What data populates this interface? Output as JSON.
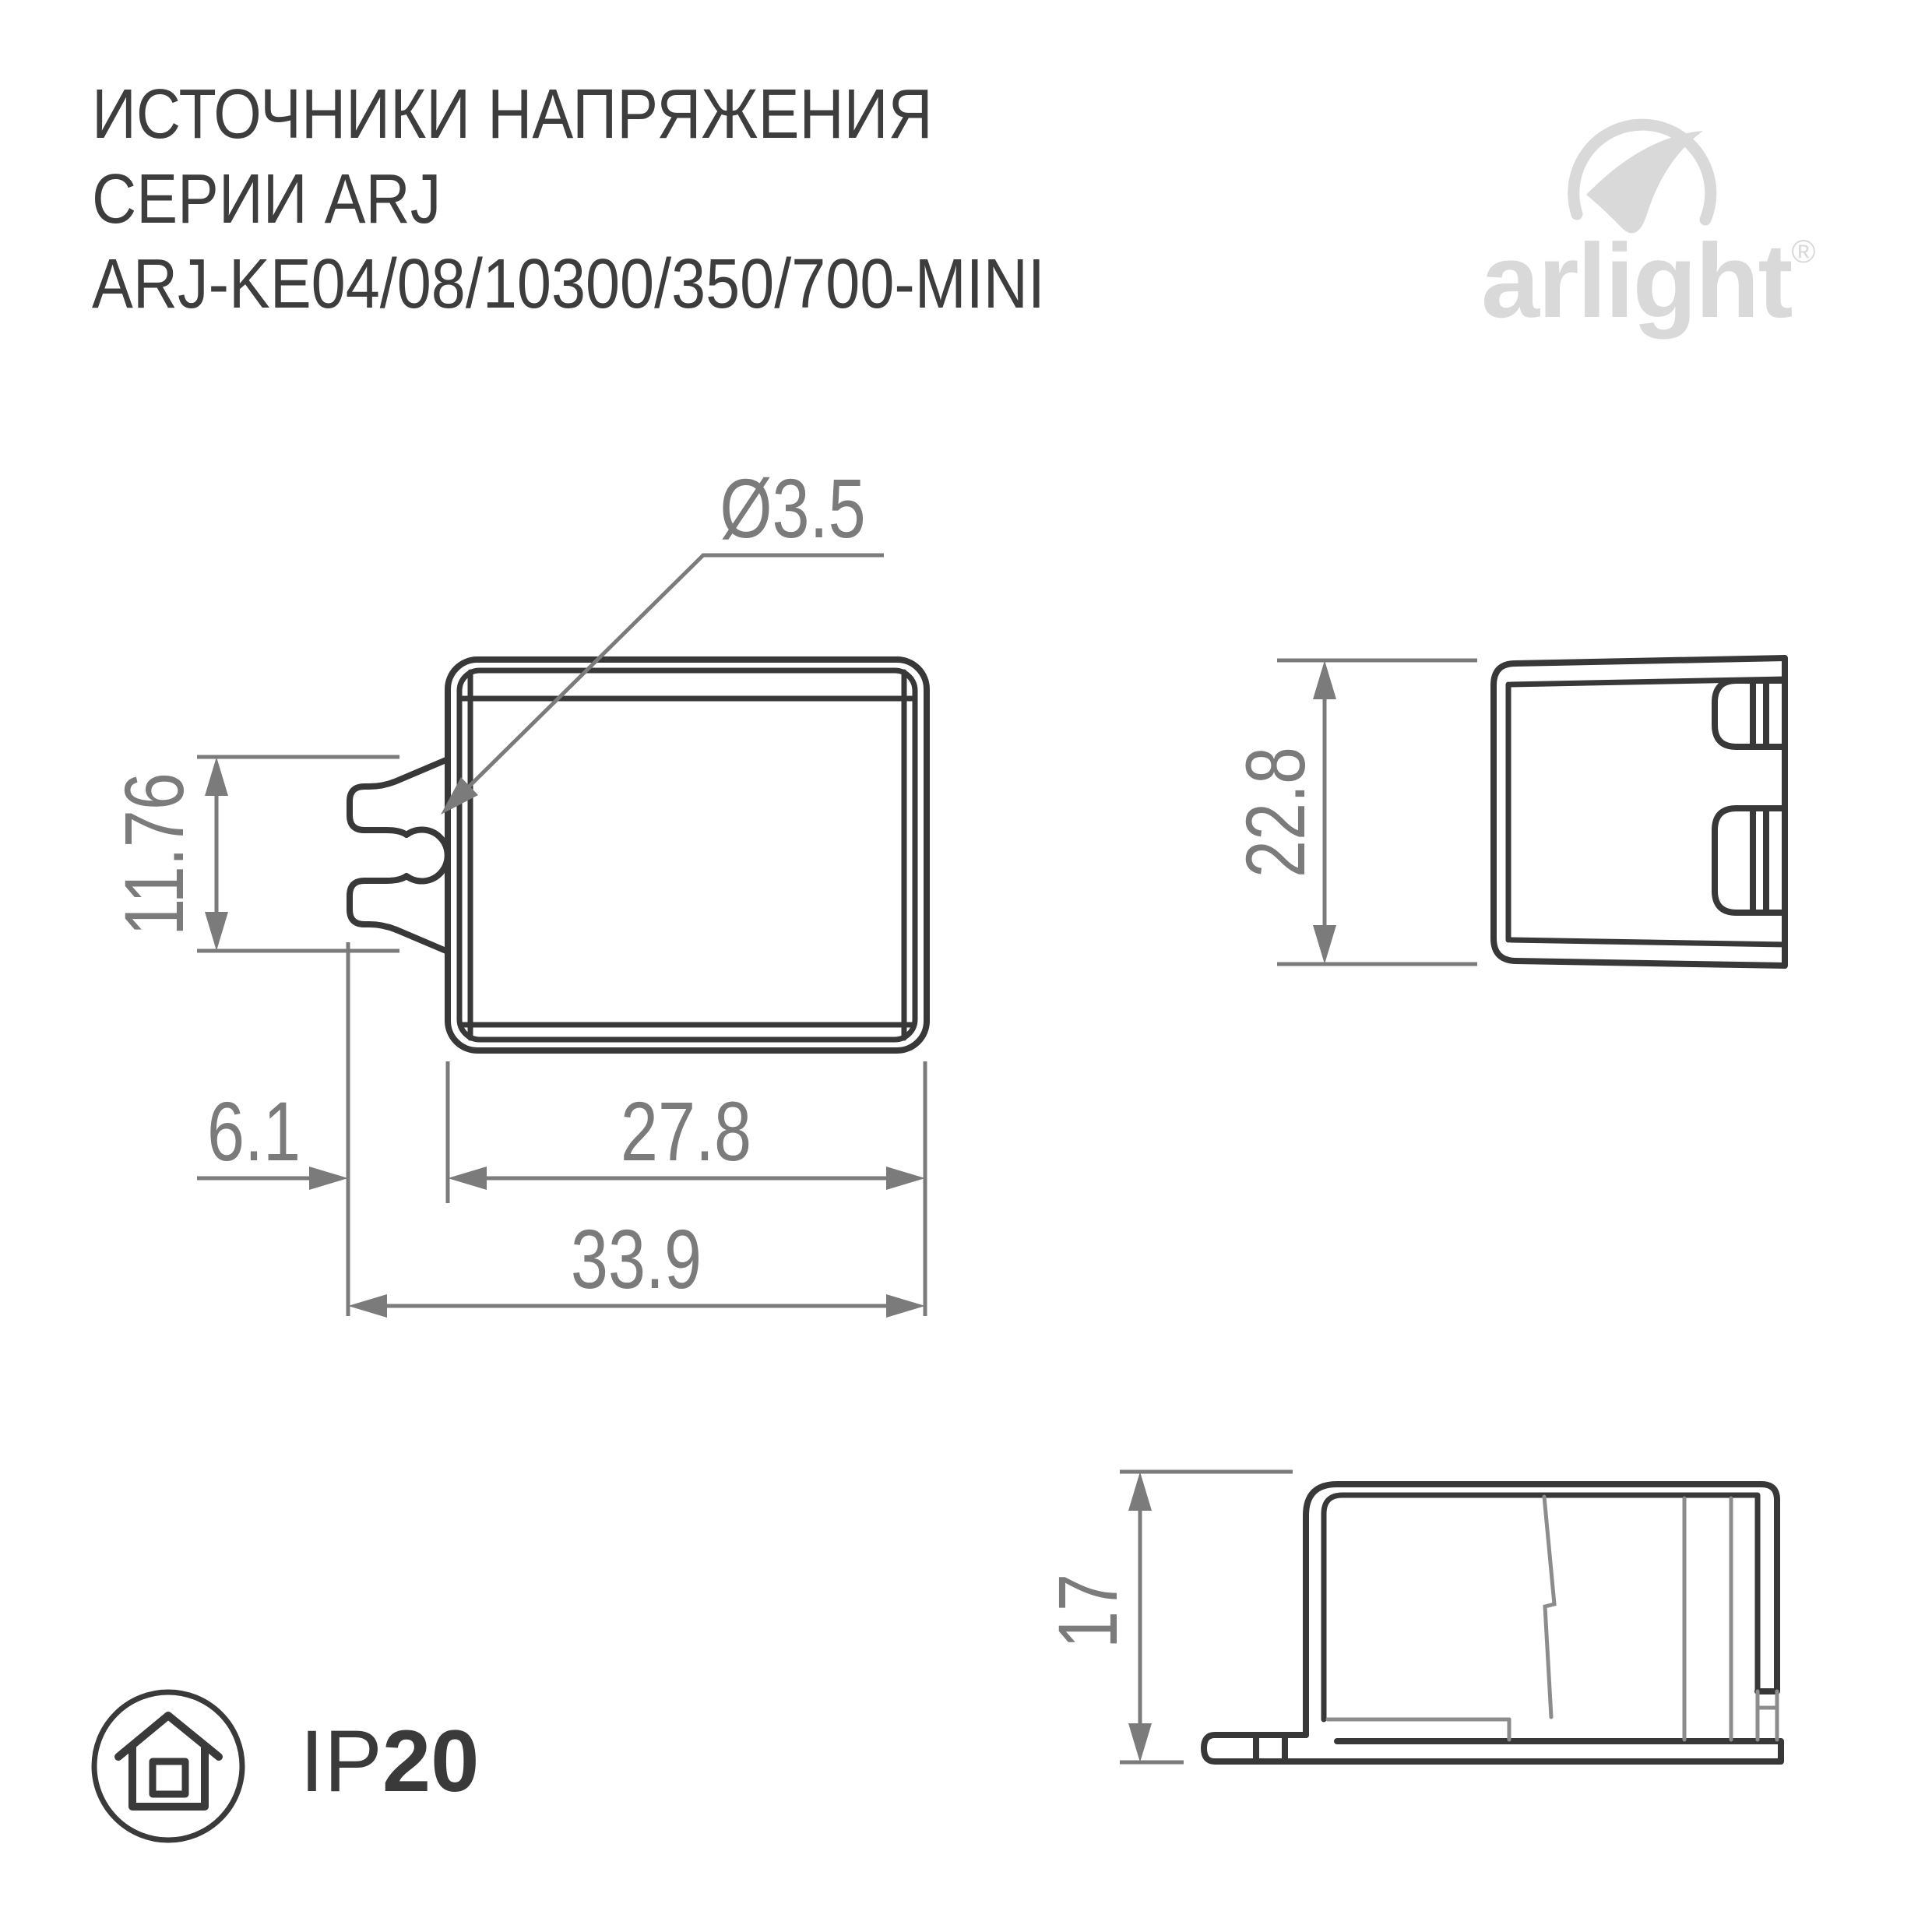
{
  "title": {
    "line1": "ИСТОЧНИКИ НАПРЯЖЕНИЯ",
    "line2": "СЕРИИ ARJ",
    "line3": "ARJ-KE04/08/10300/350/700-MINI"
  },
  "logo": {
    "text": "arlight",
    "registered": "®",
    "icon": "arlight-swoosh-icon",
    "color": "#d9d9d9"
  },
  "views": {
    "front": {
      "name": "front-view",
      "dims": {
        "hole_diameter": "Ø3.5",
        "tab_height": "11.76",
        "tab_offset": "6.1",
        "body_width": "27.8",
        "total_width": "33.9"
      }
    },
    "side": {
      "name": "side-view",
      "dims": {
        "height": "22.8"
      }
    },
    "profile": {
      "name": "profile-view",
      "dims": {
        "depth": "17"
      }
    }
  },
  "badge": {
    "ip_prefix": "IP",
    "ip_value": "20",
    "icon": "house-indoor-icon"
  },
  "colors": {
    "outline_dark": "#383838",
    "dimension_gray": "#7b7b7b",
    "hidden_gray": "#8c8c8c",
    "title_text": "#3d3d3d",
    "logo_gray": "#d9d9d9"
  }
}
